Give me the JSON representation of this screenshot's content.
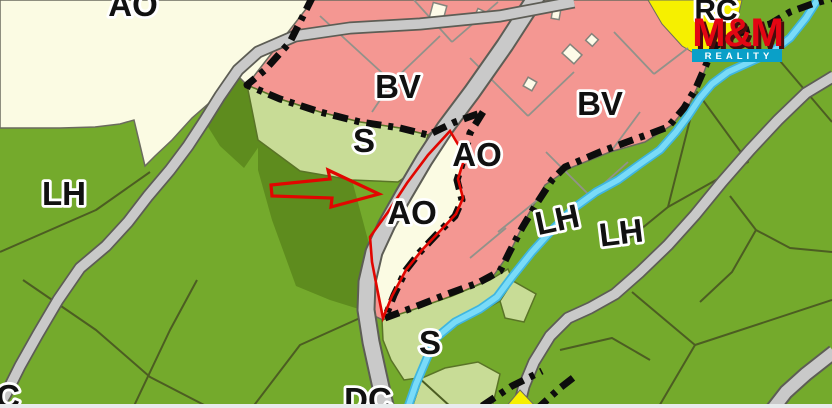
{
  "map": {
    "description": "land-use zoning map with highlighted parcel",
    "zone_labels": [
      {
        "id": "ao-top",
        "text": "AO"
      },
      {
        "id": "bv-west",
        "text": "BV"
      },
      {
        "id": "bv-east",
        "text": "BV"
      },
      {
        "id": "s-upper",
        "text": "S"
      },
      {
        "id": "ao-east",
        "text": "AO"
      },
      {
        "id": "lh-west",
        "text": "LH"
      },
      {
        "id": "ao-parcel",
        "text": "AO"
      },
      {
        "id": "lh-mid",
        "text": "LH"
      },
      {
        "id": "lh-east",
        "text": "LH"
      },
      {
        "id": "s-lower",
        "text": "S"
      },
      {
        "id": "dc-bottom",
        "text": "DC"
      },
      {
        "id": "c-corner",
        "text": "C"
      },
      {
        "id": "rc-corner",
        "text": "RC"
      }
    ],
    "watermark": {
      "brand": "M&M",
      "tagline": "REALITY"
    },
    "colors": {
      "forest_green": "#74AA2C",
      "dark_green": "#5E8C1E",
      "meadow_light_green": "#C8DC96",
      "residential_pink": "#F49792",
      "zone_cream": "#FBFBE3",
      "recreation_yellow": "#F6F000",
      "road_gray": "#C9C9C9",
      "stream_cyan": "#79DBF8",
      "boundary_black": "#0d0d0d",
      "highlight_red": "#E10600",
      "brand_red": "#E30613",
      "brand_teal": "#0AA0C8"
    }
  }
}
